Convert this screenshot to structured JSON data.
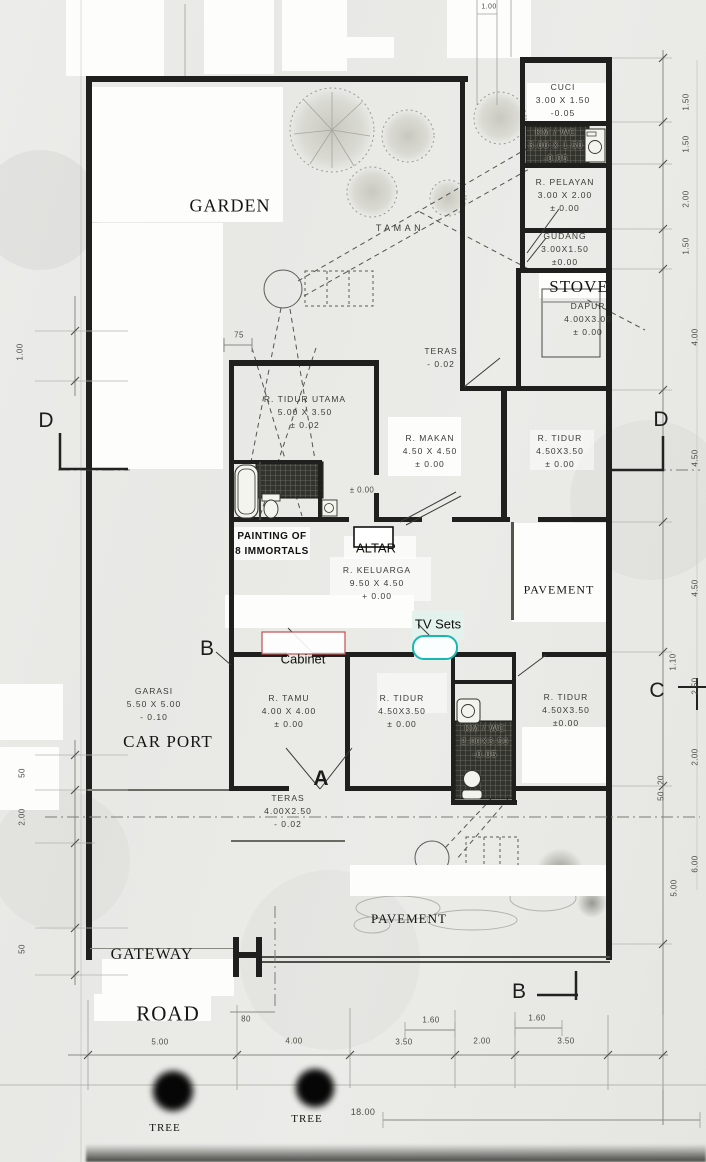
{
  "document": {
    "type": "scanned house floor plan",
    "accent_colors": {
      "cabinet_box": "#c0504d",
      "tv_box": "#17b8b4",
      "ink": "#1f1f1d"
    }
  },
  "labels": [
    {
      "n": "room-label-cuci",
      "t": "CUCI\n3.00 X 1.50\n-0.05",
      "x": 563,
      "y": 101,
      "c": "room"
    },
    {
      "n": "room-label-kmwc-top",
      "t": "KM / WC\n3.00 X 1.50\n-0.05",
      "x": 556,
      "y": 146,
      "c": "room hatchlbl"
    },
    {
      "n": "room-label-pelayan",
      "t": "R. PELAYAN\n3.00 X 2.00\n± 0.00",
      "x": 565,
      "y": 196,
      "c": "room"
    },
    {
      "n": "room-label-gudang",
      "t": "GUDANG\n3.00X1.50\n±0.00",
      "x": 565,
      "y": 250,
      "c": "room"
    },
    {
      "n": "room-label-dapur",
      "t": "DAPUR\n4.00X3.00\n± 0.00",
      "x": 588,
      "y": 320,
      "c": "room"
    },
    {
      "n": "room-label-teras-top",
      "t": "TERAS\n- 0.02",
      "x": 441,
      "y": 358,
      "c": "room"
    },
    {
      "n": "room-label-tidur-utama",
      "t": "R. TIDUR UTAMA\n5.00 X 3.50\n± 0.02",
      "x": 305,
      "y": 413,
      "c": "room"
    },
    {
      "n": "room-label-makan",
      "t": "R. MAKAN\n4.50 X 4.50\n± 0.00",
      "x": 430,
      "y": 452,
      "c": "room"
    },
    {
      "n": "room-label-tidur-ne",
      "t": "R. TIDUR\n4.50X3.50\n± 0.00",
      "x": 560,
      "y": 452,
      "c": "room"
    },
    {
      "n": "room-label-keluarga",
      "t": "R. KELUARGA\n9.50 X 4.50\n+ 0.00",
      "x": 377,
      "y": 584,
      "c": "room"
    },
    {
      "n": "room-label-garasi",
      "t": "GARASI\n5.50 X 5.00\n- 0.10",
      "x": 154,
      "y": 705,
      "c": "room"
    },
    {
      "n": "room-label-tamu",
      "t": "R. TAMU\n4.00 X 4.00\n± 0.00",
      "x": 289,
      "y": 712,
      "c": "room"
    },
    {
      "n": "room-label-tidur-mid",
      "t": "R. TIDUR\n4.50X3.50\n± 0.00",
      "x": 402,
      "y": 712,
      "c": "room"
    },
    {
      "n": "room-label-tidur-se",
      "t": "R. TIDUR\n4.50X3.50\n±0.00",
      "x": 566,
      "y": 711,
      "c": "room"
    },
    {
      "n": "room-label-kmwc-bottom",
      "t": "KM / WC\n2.00X3.50\n-0.05",
      "x": 485,
      "y": 742,
      "c": "room hatchlbl"
    },
    {
      "n": "room-label-teras-bottom",
      "t": "TERAS\n4.00X2.50\n- 0.02",
      "x": 288,
      "y": 812,
      "c": "room"
    },
    {
      "n": "label-taman",
      "t": "TAMAN",
      "x": 400,
      "y": 229,
      "c": "room sp"
    },
    {
      "n": "label-garden",
      "t": "GARDEN",
      "x": 230,
      "y": 206,
      "c": "serif s18"
    },
    {
      "n": "label-stove",
      "t": "STOVE",
      "x": 579,
      "y": 287,
      "c": "serif s17"
    },
    {
      "n": "label-car-port",
      "t": "CAR PORT",
      "x": 168,
      "y": 742,
      "c": "serif s17"
    },
    {
      "n": "label-pavement-right",
      "t": "PAVEMENT",
      "x": 559,
      "y": 590,
      "c": "serif s12"
    },
    {
      "n": "label-pavement-bottom",
      "t": "PAVEMENT",
      "x": 409,
      "y": 919,
      "c": "serif s13"
    },
    {
      "n": "label-gateway",
      "t": "GATEWAY",
      "x": 152,
      "y": 955,
      "c": "serif s16"
    },
    {
      "n": "label-road",
      "t": "ROAD",
      "x": 168,
      "y": 1014,
      "c": "serif s21"
    },
    {
      "n": "label-tree-1",
      "t": "TREE",
      "x": 165,
      "y": 1128,
      "c": "serif s11"
    },
    {
      "n": "label-tree-2",
      "t": "TREE",
      "x": 307,
      "y": 1119,
      "c": "serif s11"
    },
    {
      "n": "label-painting",
      "t": "PAINTING OF\n8 IMMORTALS",
      "x": 272,
      "y": 544,
      "c": "annotb"
    },
    {
      "n": "label-altar",
      "t": "ALTAR",
      "x": 376,
      "y": 548,
      "c": "annot s15"
    },
    {
      "n": "label-tv-sets",
      "t": "TV Sets",
      "x": 438,
      "y": 624,
      "c": "annot"
    },
    {
      "n": "label-cabinet",
      "t": "Cabinet",
      "x": 303,
      "y": 659,
      "c": "annot"
    },
    {
      "n": "label-level-altar",
      "t": "± 0.00",
      "x": 362,
      "y": 490,
      "c": "dim"
    },
    {
      "n": "marker-d-left",
      "t": "D",
      "x": 46,
      "y": 421,
      "c": "marker"
    },
    {
      "n": "marker-d-right",
      "t": "D",
      "x": 661,
      "y": 420,
      "c": "marker"
    },
    {
      "n": "marker-c-right",
      "t": "C",
      "x": 657,
      "y": 691,
      "c": "marker"
    },
    {
      "n": "marker-b-left",
      "t": "B",
      "x": 207,
      "y": 649,
      "c": "marker"
    },
    {
      "n": "marker-a",
      "t": "A",
      "x": 321,
      "y": 779,
      "c": "marker bold"
    },
    {
      "n": "marker-b-bottom",
      "t": "B",
      "x": 519,
      "y": 992,
      "c": "marker s19"
    },
    {
      "n": "dim-75",
      "t": "75",
      "x": 239,
      "y": 335,
      "c": "dim"
    },
    {
      "n": "dim-1-00-top",
      "t": "1.00",
      "x": 489,
      "y": 7,
      "c": "dim s7"
    },
    {
      "n": "dim-80",
      "t": "80",
      "x": 246,
      "y": 1019,
      "c": "dim"
    },
    {
      "n": "dim-5-00-bottom",
      "t": "5.00",
      "x": 160,
      "y": 1042,
      "c": "dim"
    },
    {
      "n": "dim-4-00-bottom",
      "t": "4.00",
      "x": 294,
      "y": 1041,
      "c": "dim"
    },
    {
      "n": "dim-1-60-a",
      "t": "1.60",
      "x": 431,
      "y": 1020,
      "c": "dim"
    },
    {
      "n": "dim-3-50-a",
      "t": "3.50",
      "x": 404,
      "y": 1042,
      "c": "dim"
    },
    {
      "n": "dim-2-00-bottom",
      "t": "2.00",
      "x": 482,
      "y": 1041,
      "c": "dim"
    },
    {
      "n": "dim-1-60-b",
      "t": "1.60",
      "x": 537,
      "y": 1018,
      "c": "dim"
    },
    {
      "n": "dim-3-50-b",
      "t": "3.50",
      "x": 566,
      "y": 1041,
      "c": "dim"
    },
    {
      "n": "dim-18-00",
      "t": "18.00",
      "x": 363,
      "y": 1112,
      "c": "dim s9"
    },
    {
      "n": "dim-1-50-r1",
      "t": "1.50",
      "x": 686,
      "y": 102,
      "c": "dim",
      "r": -90
    },
    {
      "n": "dim-1-50-r2",
      "t": "1.50",
      "x": 686,
      "y": 144,
      "c": "dim",
      "r": -90
    },
    {
      "n": "dim-2-00-r1",
      "t": "2.00",
      "x": 686,
      "y": 199,
      "c": "dim",
      "r": -90
    },
    {
      "n": "dim-1-50-r3",
      "t": "1.50",
      "x": 686,
      "y": 246,
      "c": "dim",
      "r": -90
    },
    {
      "n": "dim-4-00-r",
      "t": "4.00",
      "x": 695,
      "y": 337,
      "c": "dim",
      "r": -90
    },
    {
      "n": "dim-4-50-r1",
      "t": "4.50",
      "x": 695,
      "y": 458,
      "c": "dim",
      "r": -90
    },
    {
      "n": "dim-4-50-r2",
      "t": "4.50",
      "x": 695,
      "y": 588,
      "c": "dim",
      "r": -90
    },
    {
      "n": "dim-1-10-r",
      "t": "1.10",
      "x": 673,
      "y": 662,
      "c": "dim",
      "r": -90
    },
    {
      "n": "dim-2-50-r",
      "t": "2.50",
      "x": 695,
      "y": 686,
      "c": "dim",
      "r": -90
    },
    {
      "n": "dim-2-00-r2",
      "t": "2.00",
      "x": 695,
      "y": 757,
      "c": "dim",
      "r": -90
    },
    {
      "n": "dim-20-r",
      "t": "20",
      "x": 661,
      "y": 780,
      "c": "dim",
      "r": -90
    },
    {
      "n": "dim-50-r1",
      "t": "50",
      "x": 661,
      "y": 796,
      "c": "dim",
      "r": -90
    },
    {
      "n": "dim-6-00-r",
      "t": "6.00",
      "x": 695,
      "y": 864,
      "c": "dim",
      "r": -90
    },
    {
      "n": "dim-5-00-r",
      "t": "5.00",
      "x": 674,
      "y": 888,
      "c": "dim",
      "r": -90
    },
    {
      "n": "dim-1-00-l",
      "t": "1.00",
      "x": 20,
      "y": 352,
      "c": "dim",
      "r": -90
    },
    {
      "n": "dim-50-l1",
      "t": "50",
      "x": 22,
      "y": 773,
      "c": "dim",
      "r": -90
    },
    {
      "n": "dim-2-00-l",
      "t": "2.00",
      "x": 22,
      "y": 817,
      "c": "dim",
      "r": -90
    },
    {
      "n": "dim-50-l2",
      "t": "50",
      "x": 22,
      "y": 949,
      "c": "dim",
      "r": -90
    }
  ]
}
